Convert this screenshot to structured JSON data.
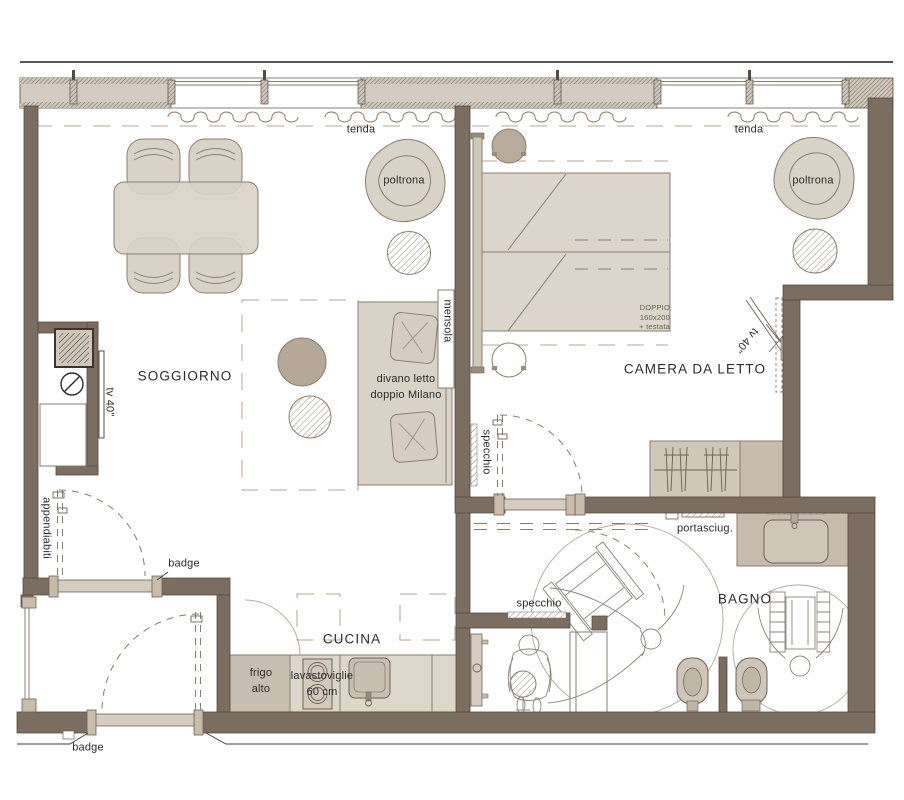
{
  "labels": {
    "tenda": "tenda",
    "poltrona": "poltrona",
    "soggiorno": "SOGGIORNO",
    "camera": "CAMERA DA LETTO",
    "mensola": "mensola",
    "divano": "divano letto\ndoppio Milano",
    "bed_spec": "DOPPIO\n160x200\n+ testata",
    "tv": "tv 40\"",
    "specchio": "specchio",
    "appendiabiti": "appendiabiti",
    "badge": "badge",
    "cucina": "CUCINA",
    "frigo": "frigo\nalto",
    "lavastoviglie": "lavastoviglie\n60 cm",
    "portasciugamani": "portasciug.",
    "bagno": "BAGNO"
  },
  "colors": {
    "wall": "#7b6e61",
    "furniture": "#d9d2c7",
    "outline": "#8b7d6e",
    "text": "#2b2b2b"
  }
}
